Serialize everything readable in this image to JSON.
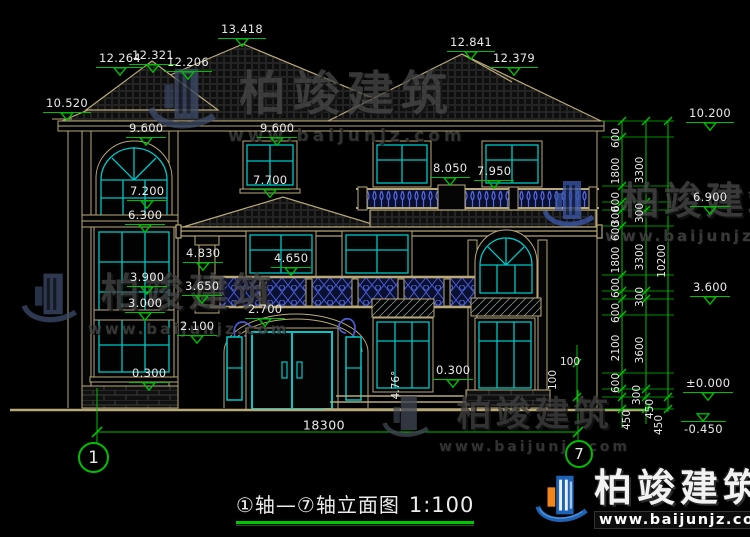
{
  "meta": {
    "width": 750,
    "height": 537,
    "description": "CAD elevation drawing, black background"
  },
  "colors": {
    "background": "#000000",
    "outline_tan": "#B9A978",
    "window_cyan": "#00C8C8",
    "dimension_green": "#00BE00",
    "text_white": "#EAEAEA",
    "railing_blue": "#4A5ACF",
    "watermark_gray": "#474747",
    "logo_blue": "#1E63B4",
    "logo_orange": "#F08519"
  },
  "watermark": {
    "name": "柏竣建筑",
    "url": "www.baijunjz.com"
  },
  "footer_logo": {
    "name": "柏竣建筑",
    "url": "www.baijunjz.com"
  },
  "title_bar": {
    "title": "①轴—⑦轴立面图",
    "scale": "1:100"
  },
  "axes": {
    "left": "1",
    "right": "7"
  },
  "bottom_dim": {
    "value": "18300"
  },
  "elevation_markers": [
    {
      "value": "13.418",
      "x": 218,
      "y": 24
    },
    {
      "value": "12.264",
      "x": 96,
      "y": 53
    },
    {
      "value": "12.321",
      "x": 129,
      "y": 50
    },
    {
      "value": "12.206",
      "x": 164,
      "y": 57
    },
    {
      "value": "12.841",
      "x": 447,
      "y": 37
    },
    {
      "value": "12.379",
      "x": 490,
      "y": 53
    },
    {
      "value": "10.520",
      "x": 43,
      "y": 98
    },
    {
      "value": "10.200",
      "x": 686,
      "y": 108
    },
    {
      "value": "9.600",
      "x": 126,
      "y": 123
    },
    {
      "value": "9.600",
      "x": 257,
      "y": 123
    },
    {
      "value": "8.050",
      "x": 430,
      "y": 163
    },
    {
      "value": "7.950",
      "x": 474,
      "y": 166
    },
    {
      "value": "7.700",
      "x": 250,
      "y": 175
    },
    {
      "value": "7.200",
      "x": 127,
      "y": 186
    },
    {
      "value": "6.300",
      "x": 125,
      "y": 210
    },
    {
      "value": "6.900",
      "x": 690,
      "y": 192
    },
    {
      "value": "4.830",
      "x": 183,
      "y": 248
    },
    {
      "value": "4.650",
      "x": 271,
      "y": 253
    },
    {
      "value": "3.900",
      "x": 127,
      "y": 272
    },
    {
      "value": "3.650",
      "x": 182,
      "y": 281
    },
    {
      "value": "3.000",
      "x": 125,
      "y": 298
    },
    {
      "value": "2.700",
      "x": 245,
      "y": 304
    },
    {
      "value": "3.600",
      "x": 690,
      "y": 282
    },
    {
      "value": "2.100",
      "x": 177,
      "y": 321
    },
    {
      "value": "0.300",
      "x": 129,
      "y": 368
    },
    {
      "value": "0.300",
      "x": 433,
      "y": 365
    },
    {
      "value": "±0.000",
      "x": 683,
      "y": 378
    },
    {
      "value": "-0.450",
      "x": 681,
      "y": 413,
      "below": true
    }
  ],
  "chain_dims": [
    {
      "v": "600",
      "x": 616,
      "y": 138
    },
    {
      "v": "1800",
      "x": 616,
      "y": 171
    },
    {
      "v": "600",
      "x": 616,
      "y": 202
    },
    {
      "v": "300",
      "x": 616,
      "y": 216
    },
    {
      "v": "600",
      "x": 616,
      "y": 231
    },
    {
      "v": "1800",
      "x": 616,
      "y": 260
    },
    {
      "v": "600",
      "x": 616,
      "y": 288
    },
    {
      "v": "600",
      "x": 616,
      "y": 313
    },
    {
      "v": "2100",
      "x": 616,
      "y": 348
    },
    {
      "v": "600",
      "x": 616,
      "y": 383
    },
    {
      "v": "450",
      "x": 627,
      "y": 420
    },
    {
      "v": "3300",
      "x": 640,
      "y": 170
    },
    {
      "v": "300",
      "x": 640,
      "y": 213
    },
    {
      "v": "3300",
      "x": 640,
      "y": 257
    },
    {
      "v": "300",
      "x": 640,
      "y": 297
    },
    {
      "v": "3600",
      "x": 640,
      "y": 350
    },
    {
      "v": "300",
      "x": 637,
      "y": 395
    },
    {
      "v": "450",
      "x": 650,
      "y": 409
    },
    {
      "v": "10200",
      "x": 662,
      "y": 261
    },
    {
      "v": "450",
      "x": 659,
      "y": 425
    }
  ],
  "small_dims": [
    {
      "v": "100",
      "x": 570,
      "y": 362,
      "rot": false
    },
    {
      "v": "100",
      "x": 553,
      "y": 380,
      "rot": true
    },
    {
      "v": "4.76°",
      "x": 396,
      "y": 385,
      "rot": true
    }
  ]
}
